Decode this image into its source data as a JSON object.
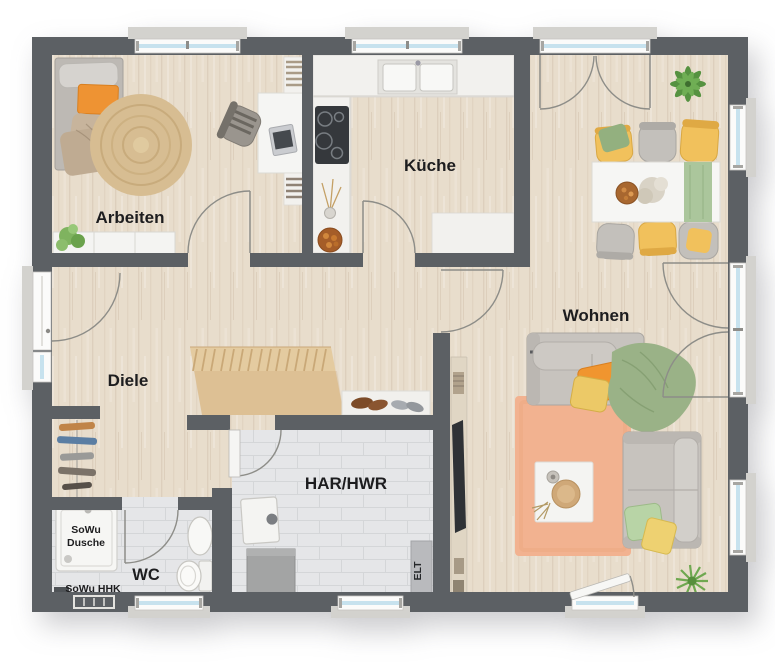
{
  "plan": {
    "type": "floor-plan",
    "labels": {
      "arbeiten": "Arbeiten",
      "kueche": "Küche",
      "wohnen": "Wohnen",
      "diele": "Diele",
      "har_hwr": "HAR/HWR",
      "wc": "WC",
      "sowu_l1": "SoWu",
      "sowu_l2": "Dusche",
      "sowu_hhk": "SoWu HHK",
      "elt": "ELT"
    }
  },
  "colors": {
    "wall": "#5c6064",
    "floor_wood": "#e8ddcc",
    "floor_tile": "#e5e6e8",
    "stairs": "#e4cba0",
    "counter": "#f2f1ee",
    "window_frame": "#fbfbfa",
    "window_glass": "#c7e2ee",
    "sill": "#d3d2ce",
    "arc": "#8d8d88",
    "label": "#1d1d1f",
    "sofa": "#c7c3be",
    "accent_orange": "#f0952f",
    "accent_yellow": "#ecc967",
    "accent_green": "#9ab287",
    "rug_living": "#f2b290",
    "rug_round": "#d7bd92",
    "table_white": "#f6f6f4"
  }
}
